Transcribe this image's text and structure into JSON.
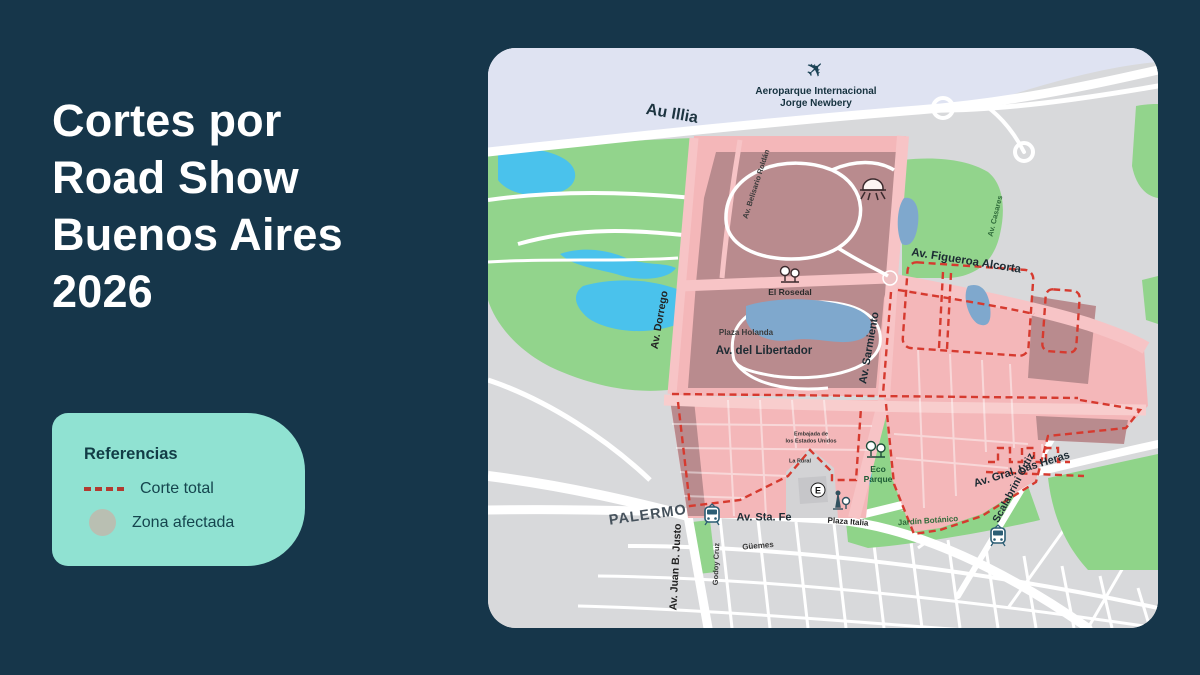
{
  "page": {
    "background_color": "#16364a"
  },
  "title": {
    "lines": [
      "Cortes por",
      "Road Show",
      "Buenos Aires",
      "2026"
    ],
    "color": "#ffffff"
  },
  "legend": {
    "title": "Referencias",
    "background_color": "#90e2d2",
    "text_color": "#123c46",
    "items": [
      {
        "label": "Corte total",
        "swatch": "dashed-red-line",
        "swatch_color": "#b23a31"
      },
      {
        "label": "Zona afectada",
        "swatch": "gray-circle",
        "swatch_color": "#b9bfb2"
      }
    ]
  },
  "map": {
    "colors": {
      "land_gray": "#d8d9db",
      "water_lavender": "#dfe3f2",
      "park_green": "#92d48c",
      "lake_cyan": "#4ac2ec",
      "lake_muted_blue": "#7fa8cd",
      "affected_zone_pink": "#f4b7b9",
      "affected_zone_dark": "#b98b8e",
      "closure_dash_red": "#d63a2f",
      "road_white": "#ffffff",
      "building_gray": "#d3d3d5"
    },
    "icons": {
      "e_station_letter": "E",
      "airplane_glyph": "✈"
    },
    "labels": [
      {
        "text": "Aeroparque Internacional\nJorge Newbery"
      },
      {
        "text": "Au Illia"
      },
      {
        "text": "Av. Belisario Roldán"
      },
      {
        "text": "El Rosedal"
      },
      {
        "text": "Av. Dorrego"
      },
      {
        "text": "Av. Figueroa Alcorta"
      },
      {
        "text": "Av. Casares"
      },
      {
        "text": "Plaza Holanda"
      },
      {
        "text": "Av. del Libertador"
      },
      {
        "text": "Av. Sarmiento"
      },
      {
        "text": "Embajada de\nlos Estados Unidos"
      },
      {
        "text": "La Rural"
      },
      {
        "text": "Eco\nParque"
      },
      {
        "text": "Av. Gral. Las Heras"
      },
      {
        "text": "Scalabrini Ortiz"
      },
      {
        "text": "Jardín Botánico"
      },
      {
        "text": "PALERMO"
      },
      {
        "text": "Av. Juan B. Justo"
      },
      {
        "text": "Godoy Cruz"
      },
      {
        "text": "Güemes"
      },
      {
        "text": "Av. Sta. Fe"
      },
      {
        "text": "Plaza Italia"
      }
    ]
  }
}
